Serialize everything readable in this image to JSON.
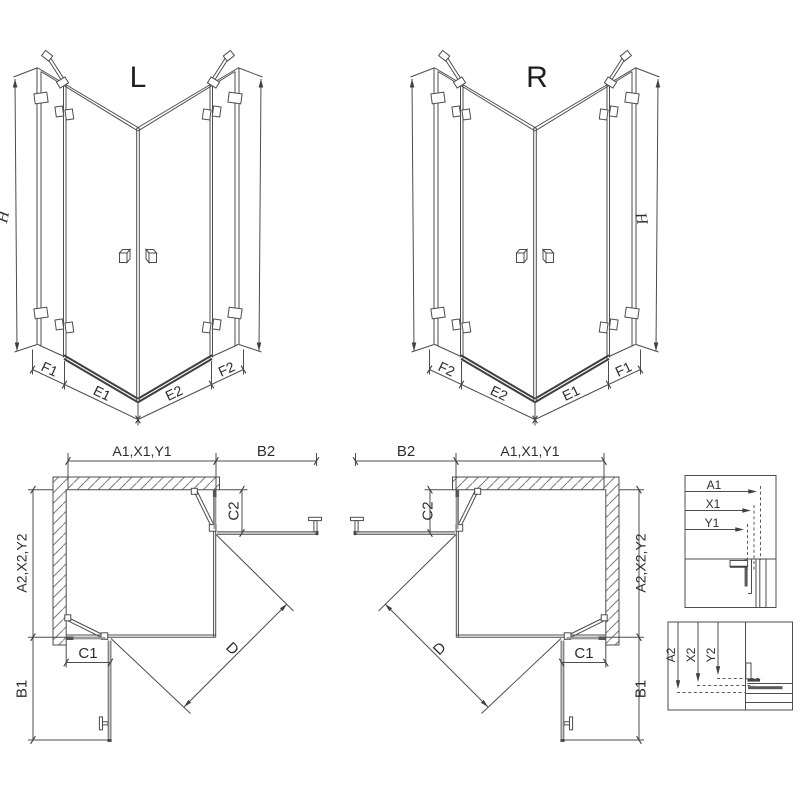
{
  "drawing": {
    "left_variant": {
      "label": "L",
      "height_dim": "H",
      "bottom_dims": [
        "F1",
        "E1",
        "E2",
        "F2"
      ]
    },
    "right_variant": {
      "label": "R",
      "height_dim": "H",
      "bottom_dims": [
        "F2",
        "E2",
        "E1",
        "F1"
      ]
    },
    "left_plan": {
      "width_dim": "A1,X1,Y1",
      "door_swing_side": "B2",
      "pivot_offset_side": "C2",
      "depth_dim": "A2,X2,Y2",
      "pivot_offset_front": "C1",
      "door_swing_front": "B1",
      "diagonal_dim": "D"
    },
    "right_plan": {
      "width_dim": "A1,X1,Y1",
      "door_swing_side": "B2",
      "pivot_offset_side": "C2",
      "depth_dim": "A2,X2,Y2",
      "pivot_offset_front": "C1",
      "door_swing_front": "B1",
      "diagonal_dim": "D"
    },
    "width_detail": {
      "dims": [
        "A1",
        "X1",
        "Y1"
      ]
    },
    "depth_detail": {
      "dims": [
        "A2",
        "X2",
        "Y2"
      ]
    }
  }
}
